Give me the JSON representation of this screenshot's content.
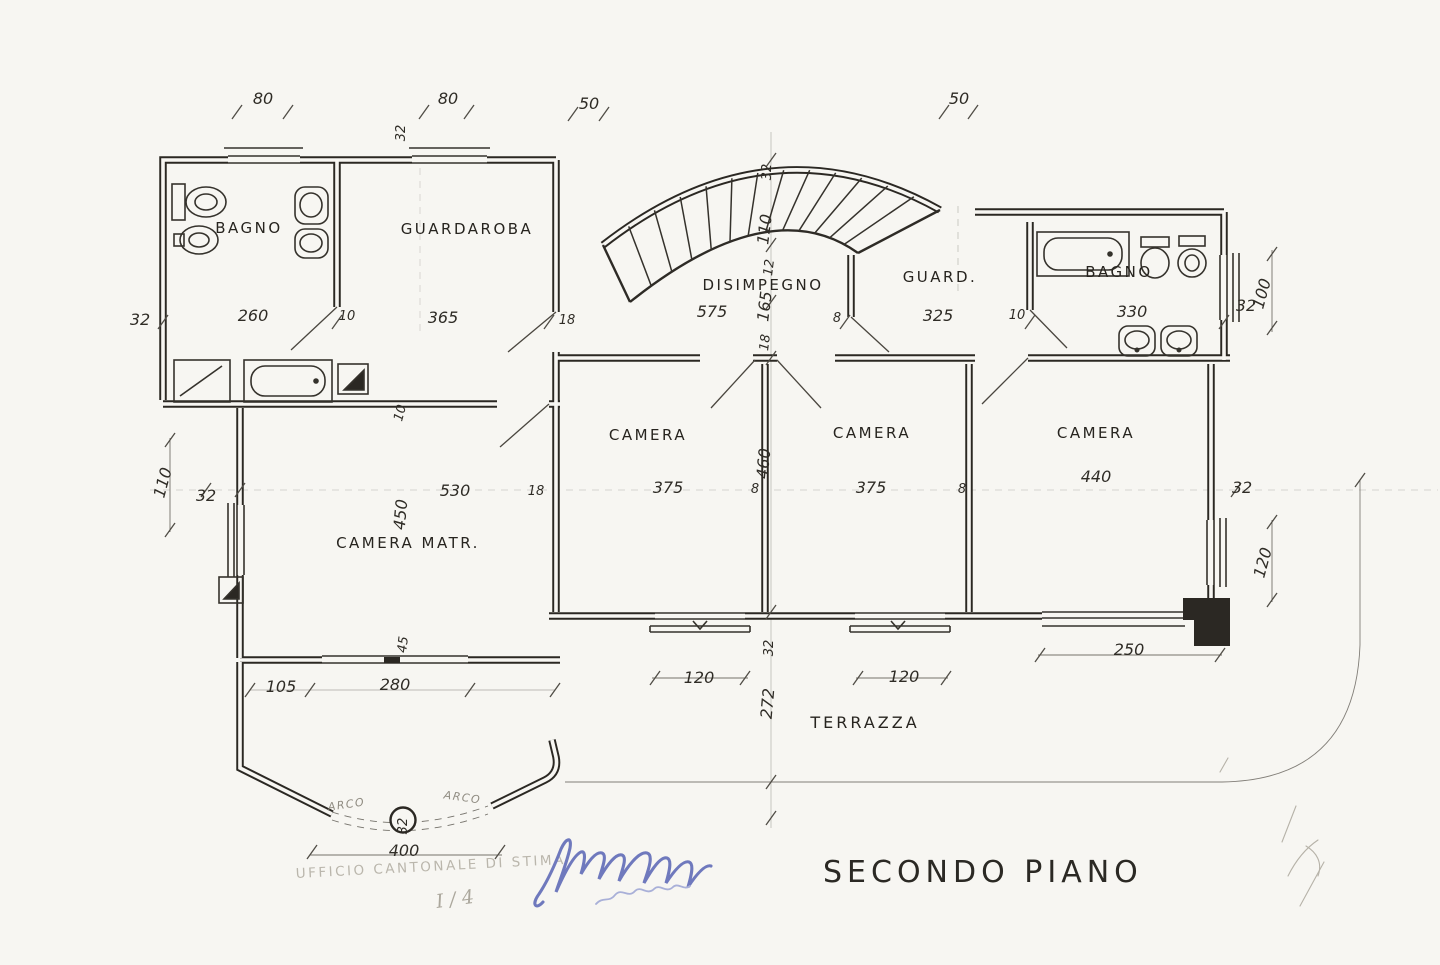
{
  "title": {
    "label": "SECONDO PIANO"
  },
  "stamp": {
    "label": "UFFICIO CANTONALE DI STIMA"
  },
  "pencil_note": {
    "label": "I / 4"
  },
  "colors": {
    "paper": "#f7f6f2",
    "ink": "#2b2823",
    "signature_blue": "#6f79bd",
    "stamp_gray": "#bab6ac"
  },
  "floor": "SECONDO PIANO",
  "rooms": [
    {
      "id": "bagno-left",
      "label": "BAGNO",
      "x": 249,
      "y": 233,
      "big": false
    },
    {
      "id": "guardaroba",
      "label": "GUARDAROBA",
      "x": 467,
      "y": 234,
      "big": false
    },
    {
      "id": "disimpegno",
      "label": "DISIMPEGNO",
      "x": 763,
      "y": 290,
      "big": false
    },
    {
      "id": "guard",
      "label": "GUARD.",
      "x": 940,
      "y": 282,
      "big": false
    },
    {
      "id": "bagno-right",
      "label": "BAGNO",
      "x": 1119,
      "y": 277,
      "big": false
    },
    {
      "id": "camera-1",
      "label": "CAMERA",
      "x": 648,
      "y": 440,
      "big": false
    },
    {
      "id": "camera-2",
      "label": "CAMERA",
      "x": 872,
      "y": 438,
      "big": false
    },
    {
      "id": "camera-3",
      "label": "CAMERA",
      "x": 1096,
      "y": 438,
      "big": false
    },
    {
      "id": "camera-matr",
      "label": "CAMERA MATR.",
      "x": 408,
      "y": 548,
      "big": false
    },
    {
      "id": "terrazza",
      "label": "TERRAZZA",
      "x": 865,
      "y": 728,
      "big": true
    }
  ],
  "dimensions": [
    {
      "label": "80",
      "x": 263,
      "y": 104,
      "rot": 0,
      "small": false
    },
    {
      "label": "80",
      "x": 448,
      "y": 104,
      "rot": 0,
      "small": false
    },
    {
      "label": "50",
      "x": 589,
      "y": 109,
      "rot": 0,
      "small": false
    },
    {
      "label": "50",
      "x": 959,
      "y": 104,
      "rot": 0,
      "small": false
    },
    {
      "label": "32",
      "x": 405,
      "y": 133,
      "rot": -90,
      "small": true
    },
    {
      "label": "32",
      "x": 771,
      "y": 172,
      "rot": -90,
      "small": true
    },
    {
      "label": "32",
      "x": 140,
      "y": 325,
      "rot": 0,
      "small": false
    },
    {
      "label": "260",
      "x": 253,
      "y": 321,
      "rot": 0,
      "small": false
    },
    {
      "label": "10",
      "x": 347,
      "y": 320,
      "rot": 0,
      "small": true
    },
    {
      "label": "365",
      "x": 443,
      "y": 323,
      "rot": 0,
      "small": false
    },
    {
      "label": "18",
      "x": 567,
      "y": 324,
      "rot": 0,
      "small": true
    },
    {
      "label": "575",
      "x": 712,
      "y": 317,
      "rot": 0,
      "small": false
    },
    {
      "label": "110",
      "x": 770,
      "y": 230,
      "rot": -83,
      "small": false
    },
    {
      "label": "12",
      "x": 773,
      "y": 268,
      "rot": -83,
      "small": true
    },
    {
      "label": "165",
      "x": 770,
      "y": 307,
      "rot": -83,
      "small": false
    },
    {
      "label": "18",
      "x": 769,
      "y": 343,
      "rot": -83,
      "small": true
    },
    {
      "label": "8",
      "x": 837,
      "y": 322,
      "rot": 0,
      "small": true
    },
    {
      "label": "325",
      "x": 938,
      "y": 321,
      "rot": 0,
      "small": false
    },
    {
      "label": "10",
      "x": 1017,
      "y": 319,
      "rot": 0,
      "small": true
    },
    {
      "label": "330",
      "x": 1132,
      "y": 317,
      "rot": 0,
      "small": false
    },
    {
      "label": "32",
      "x": 1246,
      "y": 311,
      "rot": 0,
      "small": false
    },
    {
      "label": "100",
      "x": 1267,
      "y": 295,
      "rot": -75,
      "small": false
    },
    {
      "label": "110",
      "x": 168,
      "y": 484,
      "rot": -75,
      "small": false
    },
    {
      "label": "32",
      "x": 206,
      "y": 501,
      "rot": 0,
      "small": false
    },
    {
      "label": "530",
      "x": 455,
      "y": 496,
      "rot": 0,
      "small": false
    },
    {
      "label": "450",
      "x": 406,
      "y": 515,
      "rot": -85,
      "small": false
    },
    {
      "label": "10",
      "x": 404,
      "y": 414,
      "rot": -75,
      "small": true
    },
    {
      "label": "18",
      "x": 536,
      "y": 495,
      "rot": 0,
      "small": true
    },
    {
      "label": "375",
      "x": 668,
      "y": 493,
      "rot": 0,
      "small": false
    },
    {
      "label": "8",
      "x": 755,
      "y": 493,
      "rot": 0,
      "small": true
    },
    {
      "label": "460",
      "x": 769,
      "y": 464,
      "rot": -85,
      "small": false
    },
    {
      "label": "375",
      "x": 871,
      "y": 493,
      "rot": 0,
      "small": false
    },
    {
      "label": "8",
      "x": 962,
      "y": 493,
      "rot": 0,
      "small": true
    },
    {
      "label": "440",
      "x": 1096,
      "y": 482,
      "rot": 0,
      "small": false
    },
    {
      "label": "32",
      "x": 1242,
      "y": 493,
      "rot": 0,
      "small": false
    },
    {
      "label": "120",
      "x": 1268,
      "y": 564,
      "rot": -75,
      "small": false
    },
    {
      "label": "45",
      "x": 407,
      "y": 645,
      "rot": -83,
      "small": true
    },
    {
      "label": "105",
      "x": 281,
      "y": 692,
      "rot": 0,
      "small": false
    },
    {
      "label": "280",
      "x": 395,
      "y": 690,
      "rot": 0,
      "small": false
    },
    {
      "label": "32",
      "x": 773,
      "y": 648,
      "rot": -90,
      "small": true
    },
    {
      "label": "272",
      "x": 773,
      "y": 704,
      "rot": -85,
      "small": false
    },
    {
      "label": "120",
      "x": 699,
      "y": 683,
      "rot": 0,
      "small": false
    },
    {
      "label": "120",
      "x": 904,
      "y": 682,
      "rot": 0,
      "small": false
    },
    {
      "label": "250",
      "x": 1129,
      "y": 655,
      "rot": 0,
      "small": false
    },
    {
      "label": "32",
      "x": 407,
      "y": 826,
      "rot": -90,
      "small": true
    },
    {
      "label": "400",
      "x": 404,
      "y": 856,
      "rot": 0,
      "small": false
    }
  ],
  "arc_labels": [
    {
      "label": "ARCO",
      "x": 347,
      "y": 808,
      "rot": -8
    },
    {
      "label": "ARCO",
      "x": 462,
      "y": 801,
      "rot": 8
    }
  ]
}
